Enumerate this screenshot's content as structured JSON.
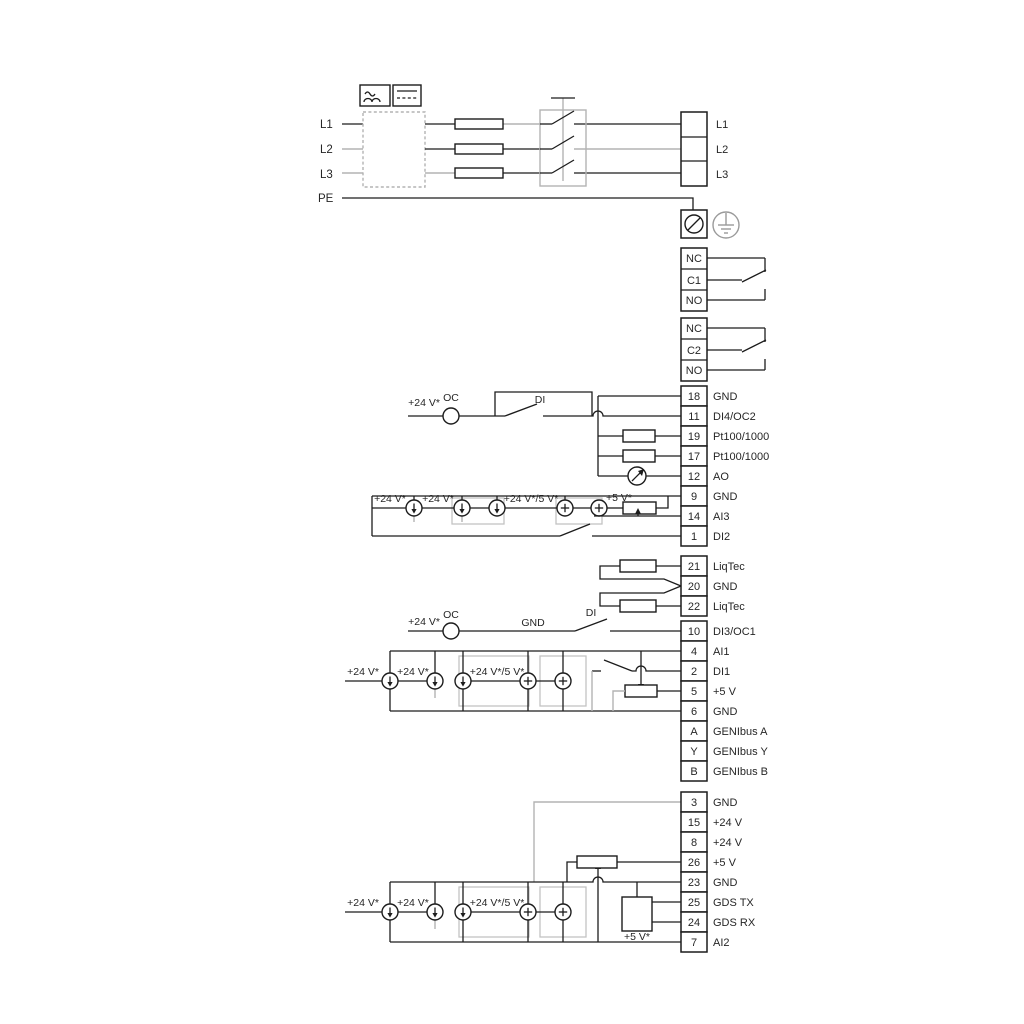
{
  "colors": {
    "wire": "#1c1c1c",
    "gray_wire": "#b3b3b3",
    "text": "#262626",
    "background": "#ffffff"
  },
  "power": {
    "inputs": [
      "L1",
      "L2",
      "L3",
      "PE"
    ],
    "outputs": [
      "L1",
      "L2",
      "L3"
    ]
  },
  "relay1": [
    "NC",
    "C1",
    "NO"
  ],
  "relay2": [
    "NC",
    "C2",
    "NO"
  ],
  "io1": [
    {
      "n": "18",
      "l": "GND"
    },
    {
      "n": "11",
      "l": "DI4/OC2"
    },
    {
      "n": "19",
      "l": "Pt100/1000"
    },
    {
      "n": "17",
      "l": "Pt100/1000"
    },
    {
      "n": "12",
      "l": "AO"
    },
    {
      "n": "9",
      "l": "GND"
    },
    {
      "n": "14",
      "l": "AI3"
    },
    {
      "n": "1",
      "l": "DI2"
    }
  ],
  "liqtec": [
    {
      "n": "21",
      "l": "LiqTec"
    },
    {
      "n": "20",
      "l": "GND"
    },
    {
      "n": "22",
      "l": "LiqTec"
    }
  ],
  "io2": [
    {
      "n": "10",
      "l": "DI3/OC1"
    },
    {
      "n": "4",
      "l": "AI1"
    },
    {
      "n": "2",
      "l": "DI1"
    },
    {
      "n": "5",
      "l": "+5 V"
    },
    {
      "n": "6",
      "l": "GND"
    },
    {
      "n": "A",
      "l": "GENIbus A"
    },
    {
      "n": "Y",
      "l": "GENIbus Y"
    },
    {
      "n": "B",
      "l": "GENIbus B"
    }
  ],
  "io3": [
    {
      "n": "3",
      "l": "GND"
    },
    {
      "n": "15",
      "l": "+24 V"
    },
    {
      "n": "8",
      "l": "+24 V"
    },
    {
      "n": "26",
      "l": "+5 V"
    },
    {
      "n": "23",
      "l": "GND"
    },
    {
      "n": "25",
      "l": "GDS TX"
    },
    {
      "n": "24",
      "l": "GDS RX"
    },
    {
      "n": "7",
      "l": "AI2"
    }
  ],
  "labels": {
    "v24": "+24 V*",
    "v24_5": "+24 V*/5 V*",
    "v5": "+5 V*",
    "oc": "OC",
    "di": "DI",
    "gnd": "GND"
  }
}
